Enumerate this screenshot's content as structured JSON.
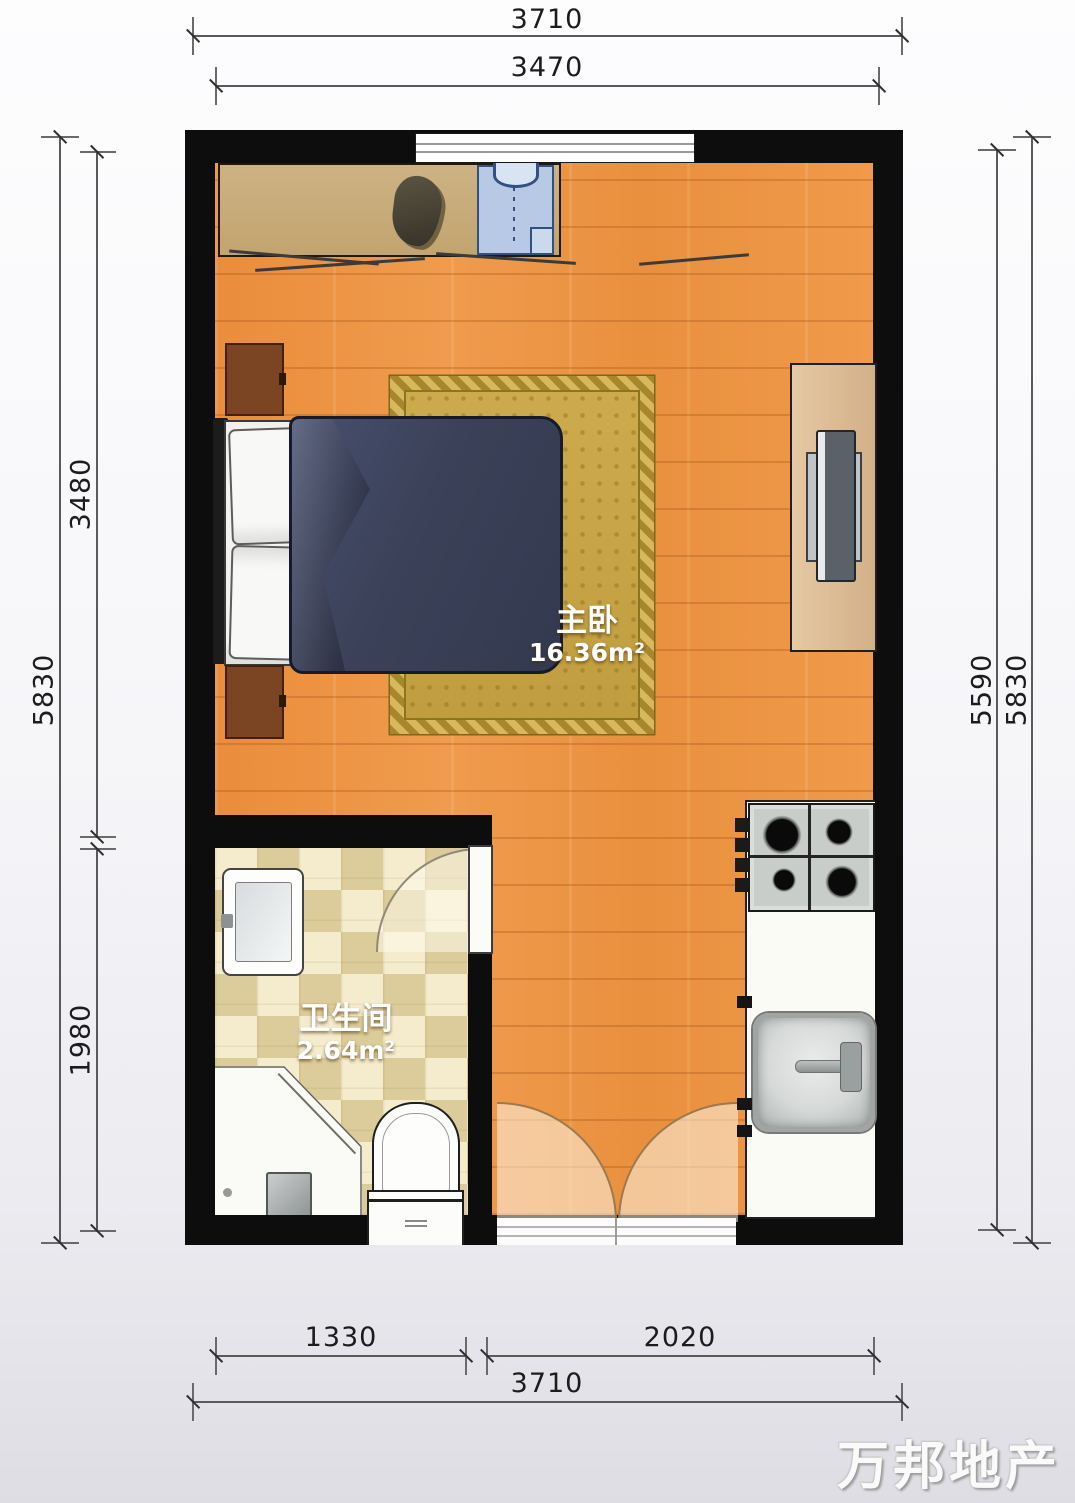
{
  "title": "apartment floor plan",
  "watermark": "万邦地产",
  "rooms": {
    "bedroom": {
      "name": "主卧",
      "area": "16.36m²"
    },
    "bathroom": {
      "name": "卫生间",
      "area": "2.64m²"
    }
  },
  "dimensions": {
    "top_outer": "3710",
    "top_inner": "3470",
    "left_outer": "5830",
    "left_upper": "3480",
    "left_lower": "1980",
    "right_inner": "5590",
    "right_outer": "5830",
    "bottom_left": "1330",
    "bottom_right": "2020",
    "bottom_outer": "3710"
  },
  "colors": {
    "wall": "#0D0D0D",
    "wood_floor": "#EC9140",
    "bathroom_tile": "#EFE3BE",
    "rug_gold": "#C7A445",
    "duvet_navy": "#3B4158",
    "counter_white": "#FBFBF7",
    "dimension_text": "#1C1C1C"
  }
}
